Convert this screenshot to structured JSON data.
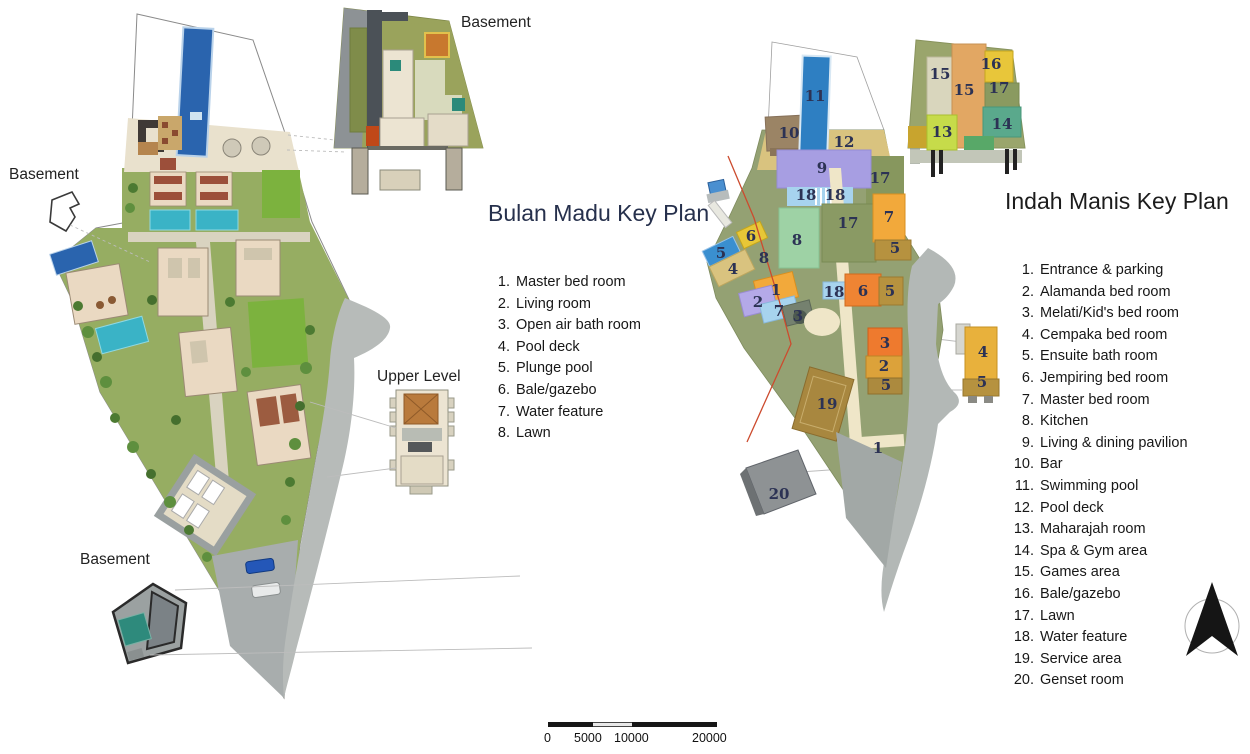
{
  "left_plan": {
    "title": "Bulan Madu Key Plan",
    "labels": {
      "basement_side": "Basement",
      "basement_inset": "Basement",
      "basement_bottom": "Basement",
      "upper_level": "Upper Level"
    },
    "legend": [
      {
        "num": "1.",
        "label": "Master bed room"
      },
      {
        "num": "2.",
        "label": "Living room"
      },
      {
        "num": "3.",
        "label": "Open air bath room"
      },
      {
        "num": "4.",
        "label": "Pool deck"
      },
      {
        "num": "5.",
        "label": "Plunge pool"
      },
      {
        "num": "6.",
        "label": "Bale/gazebo"
      },
      {
        "num": "7.",
        "label": "Water feature"
      },
      {
        "num": "8.",
        "label": "Lawn"
      }
    ]
  },
  "right_plan": {
    "title": "Indah Manis Key Plan",
    "legend": [
      {
        "num": "1.",
        "label": "Entrance & parking"
      },
      {
        "num": "2.",
        "label": "Alamanda bed room"
      },
      {
        "num": "3.",
        "label": "Melati/Kid's bed room"
      },
      {
        "num": "4.",
        "label": "Cempaka bed room"
      },
      {
        "num": "5.",
        "label": "Ensuite bath room"
      },
      {
        "num": "6.",
        "label": "Jempiring bed room"
      },
      {
        "num": "7.",
        "label": "Master bed room"
      },
      {
        "num": "8.",
        "label": "Kitchen"
      },
      {
        "num": "9.",
        "label": "Living & dining pavilion"
      },
      {
        "num": "10.",
        "label": "Bar"
      },
      {
        "num": "11.",
        "label": "Swimming pool"
      },
      {
        "num": "12.",
        "label": "Pool deck"
      },
      {
        "num": "13.",
        "label": "Maharajah room"
      },
      {
        "num": "14.",
        "label": "Spa & Gym area"
      },
      {
        "num": "15.",
        "label": "Games area"
      },
      {
        "num": "16.",
        "label": "Bale/gazebo"
      },
      {
        "num": "17.",
        "label": "Lawn"
      },
      {
        "num": "18.",
        "label": "Water feature"
      },
      {
        "num": "19.",
        "label": "Service area"
      },
      {
        "num": "20.",
        "label": "Genset room"
      }
    ],
    "markers": [
      {
        "n": "11",
        "x": 815,
        "y": 96
      },
      {
        "n": "10",
        "x": 789,
        "y": 133
      },
      {
        "n": "12",
        "x": 844,
        "y": 142
      },
      {
        "n": "9",
        "x": 822,
        "y": 168
      },
      {
        "n": "17",
        "x": 880,
        "y": 178
      },
      {
        "n": "18",
        "x": 806,
        "y": 195
      },
      {
        "n": "18",
        "x": 835,
        "y": 195
      },
      {
        "n": "17",
        "x": 848,
        "y": 223
      },
      {
        "n": "7",
        "x": 889,
        "y": 217
      },
      {
        "n": "5",
        "x": 895,
        "y": 248
      },
      {
        "n": "8",
        "x": 797,
        "y": 240
      },
      {
        "n": "6",
        "x": 751,
        "y": 236
      },
      {
        "n": "5",
        "x": 721,
        "y": 253
      },
      {
        "n": "8",
        "x": 764,
        "y": 258
      },
      {
        "n": "4",
        "x": 733,
        "y": 269
      },
      {
        "n": "1",
        "x": 776,
        "y": 290
      },
      {
        "n": "2",
        "x": 758,
        "y": 302
      },
      {
        "n": "7",
        "x": 779,
        "y": 311
      },
      {
        "n": "3",
        "x": 798,
        "y": 316
      },
      {
        "n": "18",
        "x": 834,
        "y": 292
      },
      {
        "n": "6",
        "x": 863,
        "y": 291
      },
      {
        "n": "5",
        "x": 890,
        "y": 291
      },
      {
        "n": "3",
        "x": 885,
        "y": 343
      },
      {
        "n": "2",
        "x": 884,
        "y": 366
      },
      {
        "n": "5",
        "x": 886,
        "y": 385
      },
      {
        "n": "19",
        "x": 827,
        "y": 404
      },
      {
        "n": "1",
        "x": 878,
        "y": 448
      },
      {
        "n": "20",
        "x": 779,
        "y": 494
      },
      {
        "n": "15",
        "x": 940,
        "y": 74
      },
      {
        "n": "15",
        "x": 964,
        "y": 90
      },
      {
        "n": "16",
        "x": 991,
        "y": 64
      },
      {
        "n": "17",
        "x": 999,
        "y": 88
      },
      {
        "n": "14",
        "x": 1002,
        "y": 124
      },
      {
        "n": "13",
        "x": 942,
        "y": 132
      },
      {
        "n": "4",
        "x": 983,
        "y": 352
      },
      {
        "n": "5",
        "x": 982,
        "y": 382
      }
    ]
  },
  "scale_bar": {
    "ticks": [
      "0",
      "5000",
      "10000",
      "20000"
    ]
  },
  "compass": {
    "icon": "north-arrow"
  },
  "colors": {
    "swimming_pool_blue": "#2e7fc2",
    "plunge_pool_teal": "#3ab3c6",
    "pool_deck_tan": "#d9c37f",
    "pavilion_purple": "#a79ee2",
    "water_feature_blue": "#a7d3ee",
    "kitchen_green": "#9ed2a5",
    "bedroom_orange": "#f2a93b",
    "bath_khaki": "#b6923f",
    "service_brown": "#a8873f",
    "site_olive": "#94a173",
    "lawn_green": "#7cb23e",
    "road_gray": "#b7bbb9",
    "genset_gray": "#8e9294",
    "property_line_red": "#cc4b2e"
  }
}
